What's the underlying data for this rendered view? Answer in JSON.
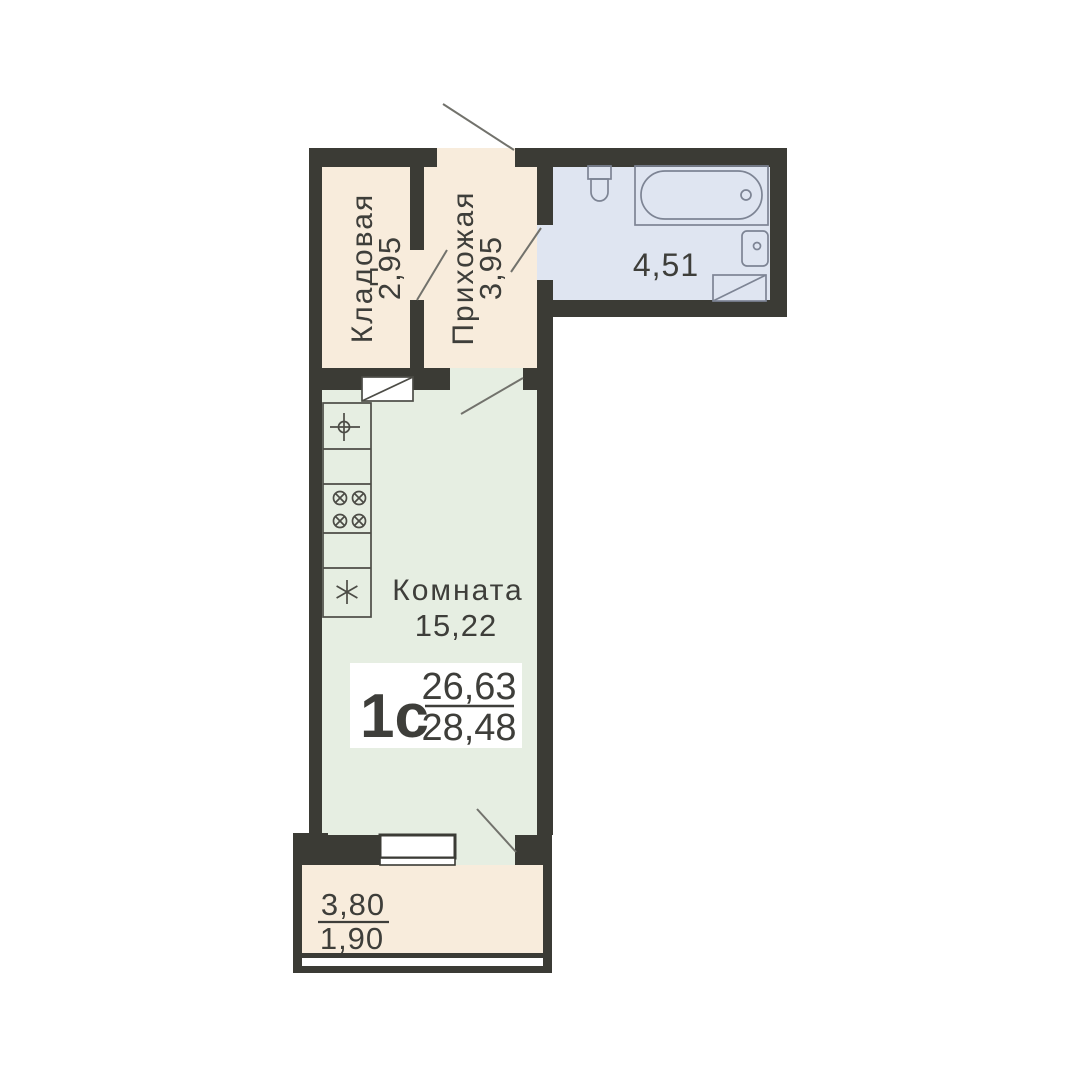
{
  "unit": {
    "type_label": "1с",
    "living_area": "26,63",
    "total_area": "28,48"
  },
  "rooms": {
    "storage": {
      "name": "Кладовая",
      "area": "2,95"
    },
    "hallway": {
      "name": "Прихожая",
      "area": "3,95"
    },
    "bathroom": {
      "area": "4,51"
    },
    "living": {
      "name": "Комната",
      "area": "15,22"
    },
    "balcony": {
      "area_total": "3,80",
      "area_reduced": "1,90"
    }
  },
  "colors": {
    "background": "#ffffff",
    "wall": "#3b3b35",
    "floor_dry": "#f8ecdc",
    "floor_wet": "#dfe5f1",
    "floor_living": "#e6eee2",
    "fixture_stroke": "#7d8494",
    "kitchen_stroke": "#4c4c46",
    "door_line": "#72726c",
    "window_frame": "#3b3b35",
    "text": "#3e3e3a"
  }
}
